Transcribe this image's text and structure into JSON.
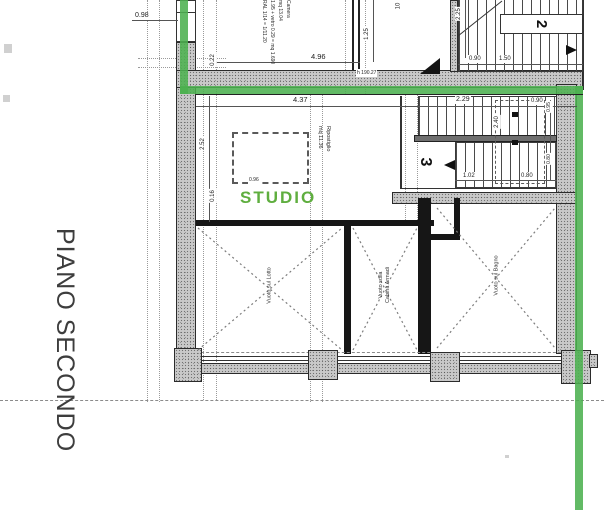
{
  "floor": {
    "label": "PIANO SECONDO"
  },
  "studio": {
    "label": "STUDIO"
  },
  "colors": {
    "highlight_line": "#4cb050",
    "studio_text": "#5fae3f"
  },
  "rooms": {
    "void_left": "Vuoto sul Lotto",
    "void_mid_line1": "Vuoto sulla",
    "void_mid_line2": "Cabina Armadi",
    "void_right": "Vuoto sul Bagno",
    "storage_line1": "Ripostiglio",
    "storage_line2": "mq 11.36",
    "camera_line1": "Camera",
    "camera_line2": "mq 13.04",
    "camera_line3": "1.95 + vetro 0.29 = mq 1.690",
    "camera_line4": "RAL 1/14 = 1/11.20"
  },
  "stairs": {
    "upper_flight_number": "2",
    "lower_flight_number": "3"
  },
  "dimensions": {
    "d098": "0.98",
    "d022": "0.22",
    "d496": "4.96",
    "d125": "1.25",
    "d10": "10",
    "d225": "2.25",
    "d090a": "0.90",
    "d150": "1.50",
    "d437": "4.37",
    "d229": "2.29",
    "d090b": "0.90",
    "d252": "2.52",
    "d016": "0.16",
    "d240": "2.40",
    "d102": "1.02",
    "d080a": "0.80",
    "d095": "0.95",
    "d080b": "0.80",
    "d096": "0.96"
  },
  "annotations": {
    "level_mark": "h 190.27"
  }
}
